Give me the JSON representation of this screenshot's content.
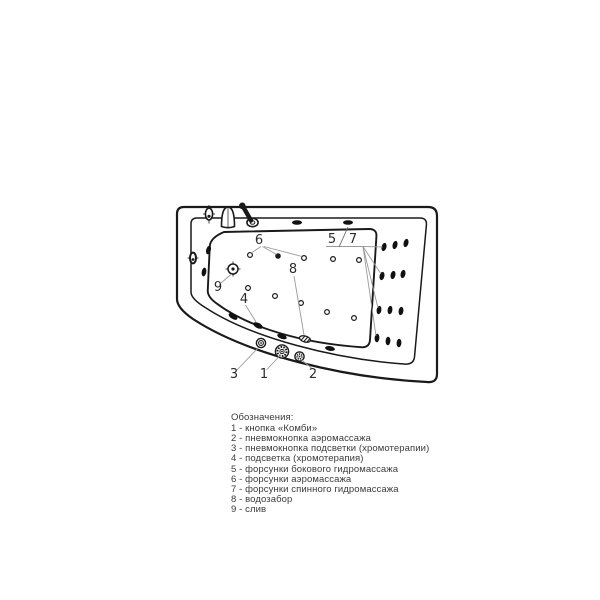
{
  "diagram": {
    "subject": "corner-whirlpool-bathtub-top-view",
    "colors": {
      "line": "#1a1a1a",
      "leader": "#9a9a9a",
      "text": "#3b3b3b",
      "background": "#ffffff"
    }
  },
  "callouts": {
    "n1": "1",
    "n2": "2",
    "n3": "3",
    "n4": "4",
    "n5": "5",
    "n6": "6",
    "n7": "7",
    "n8": "8",
    "n9": "9"
  },
  "legend": {
    "title": "Обозначения:",
    "items": [
      "1 - кнопка «Комби»",
      "2 - пневмокнопка аэромассажа",
      "3 - пневмокнопка подсветки (хромотерапии)",
      "4 - подсветка (хромотерапия)",
      "5 - форсунки бокового гидромассажа",
      "6 - форсунки аэромассажа",
      "7 - форсунки спинного гидромассажа",
      "8 - водозабор",
      "9 - слив"
    ]
  }
}
